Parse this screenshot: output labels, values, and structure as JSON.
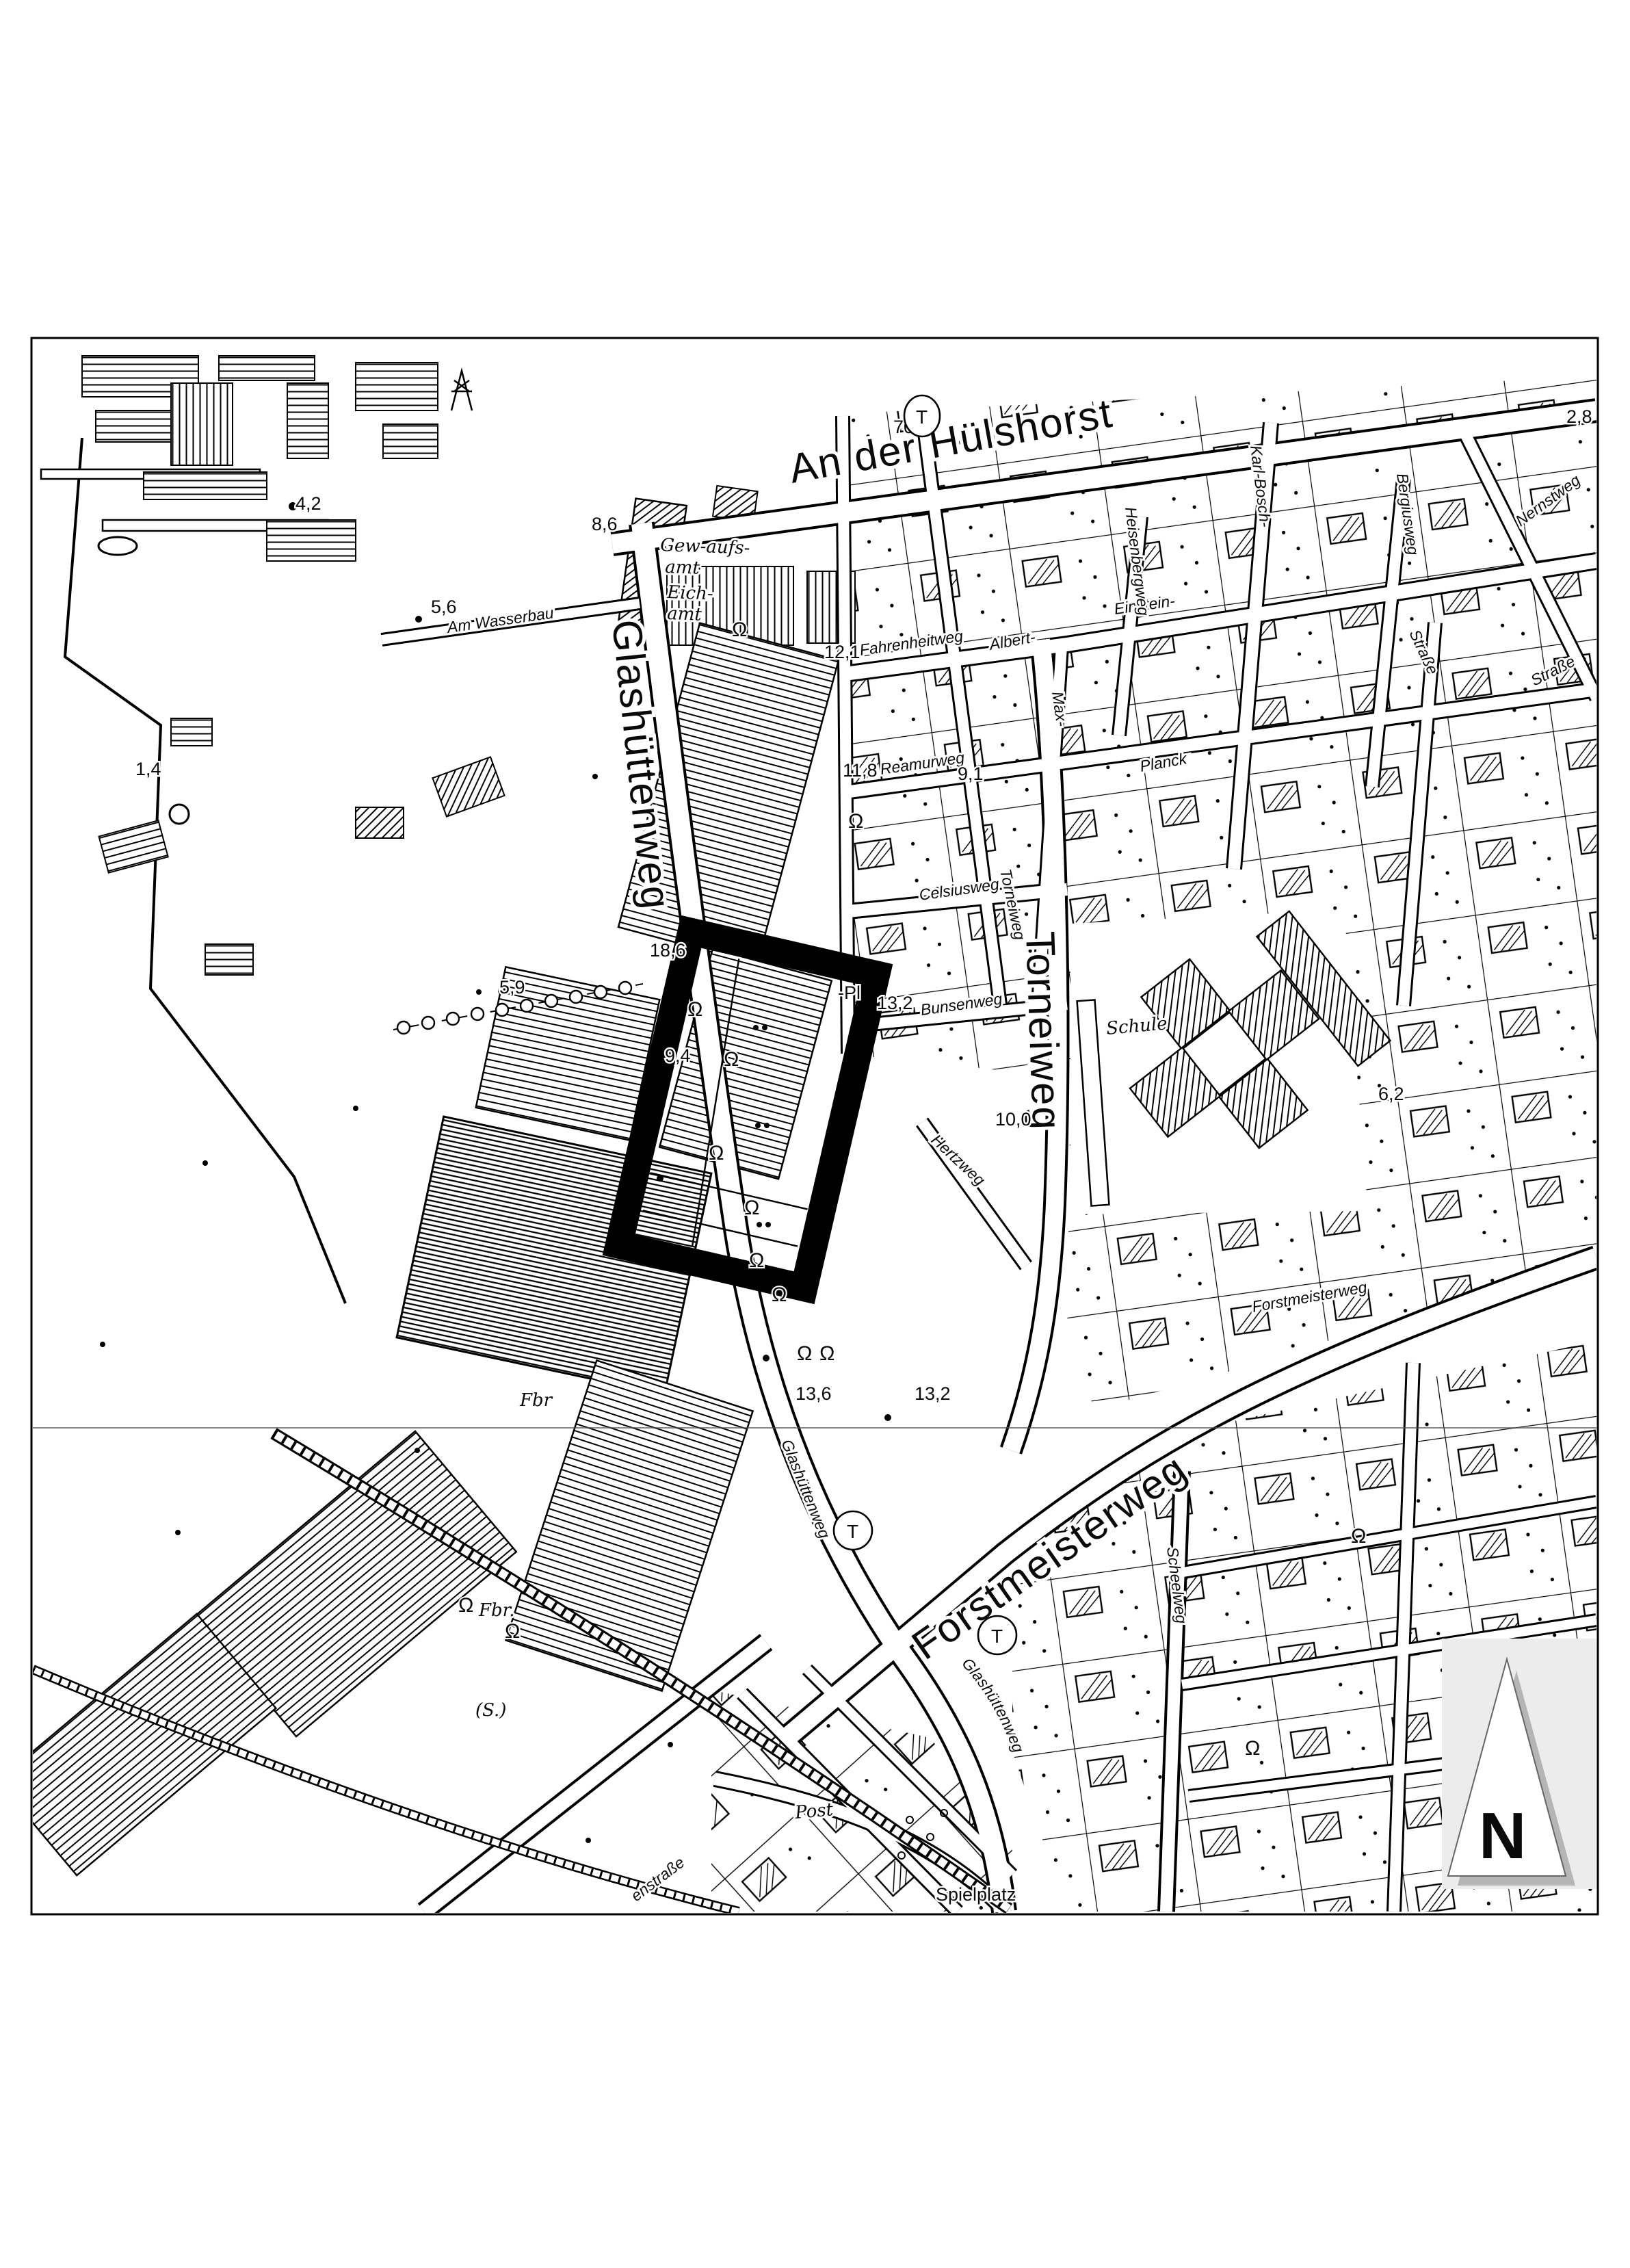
{
  "map": {
    "type": "Katasterkarte / Stadtplanausschnitt (schwarz-weiß)",
    "highlight_color": "#000000",
    "paper_color": "#ffffff",
    "north_backdrop_color": "#ececec",
    "north_shadow_color": "#b5b5b5"
  },
  "labels": {
    "an_der_huelshorst": "An der Hülshorst",
    "glashuettenweg": "Glashüttenweg",
    "torneiweg": "Torneiweg",
    "forstmeisterweg": "Forstmeisterweg",
    "am_wasserbau": "Am Wasserbau",
    "fahrenheitweg": "Fahrenheitweg",
    "albert": "Albert-",
    "einstein": "Einstein-",
    "strasse": "Straße",
    "max": "Max-",
    "planck": "Planck",
    "reamurweg": "Reamurweg",
    "celsiusweg": "Celsiusweg",
    "bunsenweg": "Bunsenweg",
    "hertzweg": "Hertzweg",
    "heisenbergweg": "Heisenbergweg",
    "karl_bosch": "Karl-Bosch-",
    "bergiusweg": "Bergiusweg",
    "nernstweg": "Nernstweg",
    "scheelweg": "Scheelweg",
    "enstrasse": "enstraße",
    "gew_aufs": "Gew-aufs-",
    "amt": "amt",
    "eich": "Eich-",
    "schule": "Schule",
    "fbr": "Fbr",
    "fbr_dot": "Fbr.",
    "s_abbrev": "(S.)",
    "post": "Post",
    "spielplatz": "Spielplatz",
    "pl_fragment": "-Pl"
  },
  "spot_heights": {
    "v42": "4,2",
    "v56": "5,6",
    "v86": "8,6",
    "v121": "12,1",
    "v118": "11,8",
    "v91": "9,1",
    "v14": "1,4",
    "v59": "5,9",
    "v186": "18,6",
    "v94": "9,4",
    "v132": "13,2",
    "v136": "13,6",
    "v100": "10,0",
    "v28": "2,8",
    "v62": "6,2",
    "v70": "70"
  },
  "symbols": {
    "transformer": "T",
    "shrub": "Ω",
    "north": "N"
  }
}
